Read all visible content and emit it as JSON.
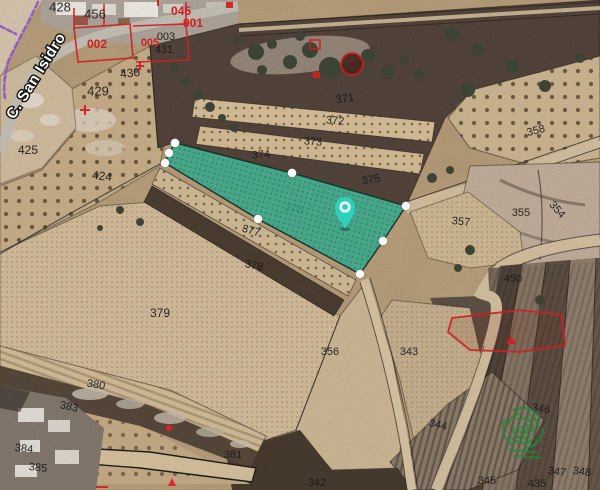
{
  "map": {
    "street": {
      "label": "C. San Isidro",
      "x": 14,
      "y": 120,
      "rotate": -58
    },
    "highlight": {
      "parcel_id": "376",
      "fill": "#2fa88c",
      "stroke": "#17332b",
      "points": [
        [
          175,
          143
        ],
        [
          292,
          173
        ],
        [
          406,
          206
        ],
        [
          383,
          241
        ],
        [
          360,
          274
        ],
        [
          258,
          219
        ],
        [
          165,
          163
        ],
        [
          169,
          153
        ]
      ],
      "vertex_dots": [
        [
          175,
          143
        ],
        [
          292,
          173
        ],
        [
          406,
          206
        ],
        [
          383,
          241
        ],
        [
          360,
          274
        ],
        [
          258,
          219
        ],
        [
          165,
          163
        ],
        [
          169,
          153
        ]
      ]
    },
    "pin": {
      "x": 345,
      "y": 209,
      "color": "#2ed0b9",
      "ring_color": "#ffffff"
    },
    "watermark": {
      "x": 523,
      "y": 428,
      "color": "#1e8a3f"
    },
    "parcel_labels": [
      {
        "t": "371",
        "x": 345,
        "y": 99,
        "r": -8
      },
      {
        "t": "372",
        "x": 335,
        "y": 121,
        "r": 4
      },
      {
        "t": "373",
        "x": 313,
        "y": 142,
        "r": 5
      },
      {
        "t": "374",
        "x": 261,
        "y": 155,
        "r": -5
      },
      {
        "t": "375",
        "x": 371,
        "y": 180,
        "r": -10
      },
      {
        "t": "376",
        "x": 294,
        "y": 209,
        "r": 12,
        "c": "#1d3a32"
      },
      {
        "t": "377",
        "x": 251,
        "y": 231,
        "r": 16
      },
      {
        "t": "378",
        "x": 254,
        "y": 266,
        "r": 12
      },
      {
        "t": "379",
        "x": 160,
        "y": 313,
        "r": 0,
        "s": 12
      },
      {
        "t": "380",
        "x": 96,
        "y": 385,
        "r": 10
      },
      {
        "t": "383",
        "x": 69,
        "y": 407,
        "r": 12
      },
      {
        "t": "384",
        "x": 24,
        "y": 449,
        "r": 6
      },
      {
        "t": "385",
        "x": 38,
        "y": 468,
        "r": 6
      },
      {
        "t": "381",
        "x": 233,
        "y": 455,
        "r": 0,
        "o": 0.65
      },
      {
        "t": "342",
        "x": 317,
        "y": 483,
        "r": 0
      },
      {
        "t": "356",
        "x": 330,
        "y": 352
      },
      {
        "t": "343",
        "x": 409,
        "y": 352
      },
      {
        "t": "344",
        "x": 438,
        "y": 425,
        "r": 14
      },
      {
        "t": "346",
        "x": 541,
        "y": 409,
        "r": 10
      },
      {
        "t": "345",
        "x": 487,
        "y": 481
      },
      {
        "t": "435",
        "x": 537,
        "y": 484
      },
      {
        "t": "347",
        "x": 557,
        "y": 472,
        "r": 8
      },
      {
        "t": "348",
        "x": 582,
        "y": 472,
        "r": 8
      },
      {
        "t": "450",
        "x": 513,
        "y": 279
      },
      {
        "t": "357",
        "x": 461,
        "y": 222,
        "r": 6
      },
      {
        "t": "355",
        "x": 521,
        "y": 213
      },
      {
        "t": "354",
        "x": 557,
        "y": 210,
        "r": 48
      },
      {
        "t": "358",
        "x": 536,
        "y": 131,
        "r": -14
      },
      {
        "t": "425",
        "x": 28,
        "y": 150,
        "s": 12
      },
      {
        "t": "424",
        "x": 102,
        "y": 176,
        "r": 6,
        "s": 12
      },
      {
        "t": "429",
        "x": 98,
        "y": 91,
        "s": 13
      },
      {
        "t": "430",
        "x": 130,
        "y": 73,
        "r": -6,
        "s": 12
      },
      {
        "t": "431",
        "x": 164,
        "y": 50
      },
      {
        "t": "003",
        "x": 166,
        "y": 37
      },
      {
        "t": "456",
        "x": 95,
        "y": 14,
        "s": 13
      },
      {
        "t": "428",
        "x": 60,
        "y": 7,
        "s": 13
      }
    ],
    "red_labels": [
      {
        "t": "002",
        "x": 97,
        "y": 44,
        "s": 12
      },
      {
        "t": "005",
        "x": 150,
        "y": 43,
        "s": 11
      },
      {
        "t": "045",
        "x": 181,
        "y": 11,
        "s": 12
      },
      {
        "t": "901",
        "x": 193,
        "y": 23,
        "s": 12
      }
    ],
    "colors": {
      "highlight_fill": "#2fa88c",
      "pin_teal": "#2ed0b9",
      "red_overlay": "#cf2020",
      "boundary_black": "#1b1b1b",
      "watermark_green": "#1e8a3f",
      "road_purple": "#9c63cf"
    }
  }
}
